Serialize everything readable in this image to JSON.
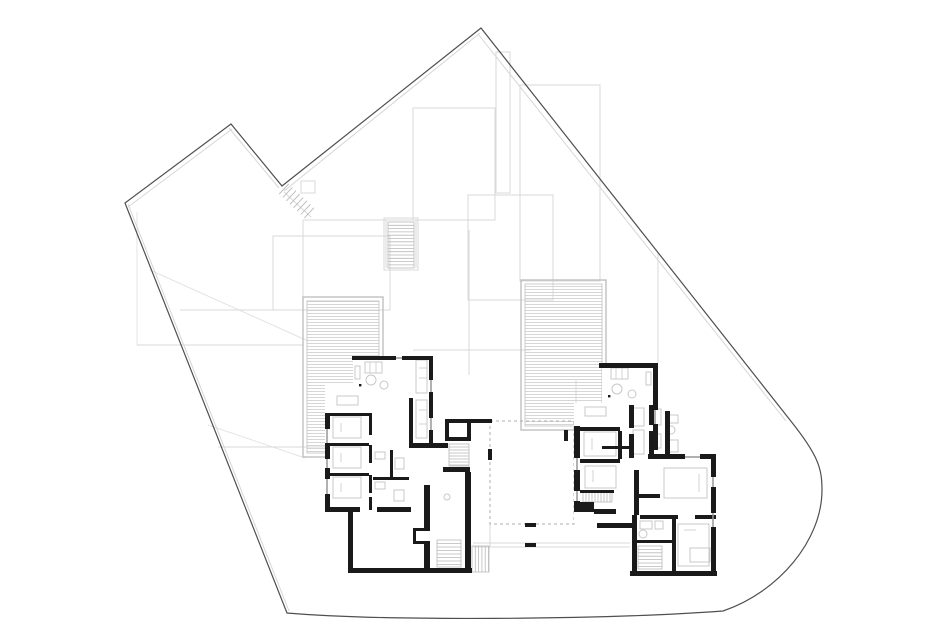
{
  "canvas": {
    "width": 940,
    "height": 635,
    "background": "#ffffff"
  },
  "colors": {
    "boundary": "#4f4f4f",
    "boundary_offset": "#d6d6d6",
    "roof_gray": "#d9d9d9",
    "terrain_gray": "#e4e4e4",
    "wall_black": "#1a1a1a",
    "window_gray": "#979797",
    "furniture_gray": "#c8c8c8",
    "stair_gray": "#b9b9b9",
    "deck_stripe": "#d2d2d2",
    "deck_frame": "#c0c0c0",
    "dash_gray": "#aeaeae",
    "fill_white": "#ffffff"
  },
  "site": {
    "boundary_path": "M125,203 L231,124 L282,186 L481,28 L790,420 C818,455 822,468 822,490 C822,540 779,592 723,611 C600,620 380,621 287,613 Z",
    "offset_lines": [
      [
        128,
        207,
        232,
        129
      ],
      [
        229,
        128,
        279,
        188
      ],
      [
        284,
        191,
        480,
        33
      ],
      [
        478,
        34,
        786,
        421
      ],
      [
        128,
        204,
        289,
        611
      ]
    ]
  },
  "gray_rects": [
    [
      413,
      108,
      82,
      112
    ],
    [
      496,
      52,
      14,
      141
    ],
    [
      468,
      195,
      85,
      105
    ],
    [
      273,
      236,
      117,
      74
    ],
    [
      520,
      85,
      80,
      196
    ],
    [
      384,
      218,
      34,
      52
    ],
    [
      301,
      181,
      14,
      12
    ]
  ],
  "gray_segments": [
    [
      303,
      220,
      413,
      220
    ],
    [
      303,
      220,
      303,
      297
    ],
    [
      180,
      310,
      390,
      310
    ],
    [
      137,
      345,
      303,
      345
    ],
    [
      218,
      447,
      400,
      447
    ],
    [
      413,
      350,
      530,
      350
    ],
    [
      658,
      252,
      658,
      367
    ],
    [
      469,
      230,
      469,
      375
    ],
    [
      386,
      220,
      386,
      268
    ],
    [
      416,
      220,
      416,
      268
    ],
    [
      284,
      192,
      311,
      217
    ],
    [
      470,
      543,
      632,
      543
    ],
    [
      470,
      547,
      632,
      547
    ],
    [
      490,
      523,
      490,
      547
    ],
    [
      330,
      385,
      330,
      415
    ],
    [
      576,
      380,
      576,
      426
    ],
    [
      602,
      367,
      602,
      405
    ]
  ],
  "terrain_segments": [
    [
      150,
      270,
      308,
      341
    ],
    [
      208,
      425,
      305,
      458
    ],
    [
      137,
      345,
      137,
      212
    ]
  ],
  "decks": [
    {
      "x": 303,
      "y": 297,
      "w": 80,
      "h": 160
    },
    {
      "x": 521,
      "y": 280,
      "w": 85,
      "h": 150
    }
  ],
  "courtyard": {
    "rect": [
      490,
      421,
      84,
      103
    ],
    "ticks": [
      [
        488,
        449,
        4,
        11
      ],
      [
        564,
        430,
        4,
        11
      ],
      [
        525,
        523,
        11,
        4
      ],
      [
        525,
        543,
        11,
        4
      ]
    ]
  },
  "unit_fills": [
    [
      353,
      356,
      80,
      92
    ],
    [
      325,
      383,
      87,
      129
    ],
    [
      405,
      396,
      30,
      52
    ],
    [
      433,
      420,
      40,
      155
    ],
    [
      348,
      511,
      77,
      62
    ],
    [
      602,
      363,
      58,
      70
    ],
    [
      574,
      403,
      82,
      120
    ],
    [
      630,
      454,
      86,
      122
    ]
  ],
  "walls": [
    [
      352,
      356,
      44,
      4
    ],
    [
      402,
      356,
      31,
      4
    ],
    [
      429,
      356,
      4,
      24
    ],
    [
      429,
      392,
      4,
      26
    ],
    [
      429,
      430,
      4,
      14
    ],
    [
      325,
      413,
      5,
      16
    ],
    [
      325,
      443,
      5,
      16
    ],
    [
      325,
      468,
      5,
      11
    ],
    [
      325,
      494,
      5,
      18
    ],
    [
      325,
      507,
      35,
      5
    ],
    [
      377,
      507,
      34,
      5
    ],
    [
      409,
      398,
      4,
      50
    ],
    [
      409,
      443,
      39,
      5
    ],
    [
      330,
      413,
      39,
      3
    ],
    [
      330,
      443,
      39,
      3
    ],
    [
      330,
      473,
      39,
      3
    ],
    [
      369,
      413,
      3,
      22
    ],
    [
      369,
      445,
      3,
      18
    ],
    [
      369,
      475,
      3,
      18
    ],
    [
      369,
      497,
      3,
      13
    ],
    [
      373,
      477,
      36,
      3
    ],
    [
      390,
      450,
      3,
      27
    ],
    [
      445,
      419,
      26,
      4
    ],
    [
      445,
      419,
      4,
      22
    ],
    [
      467,
      419,
      4,
      22
    ],
    [
      445,
      437,
      26,
      4
    ],
    [
      443,
      467,
      27,
      5
    ],
    [
      465,
      472,
      6,
      101
    ],
    [
      470,
      419,
      22,
      4
    ],
    [
      348,
      511,
      5,
      62
    ],
    [
      348,
      568,
      124,
      5
    ],
    [
      424,
      485,
      6,
      43
    ],
    [
      424,
      544,
      6,
      26
    ],
    [
      413,
      528,
      17,
      3
    ],
    [
      413,
      528,
      3,
      16
    ],
    [
      413,
      541,
      17,
      3
    ],
    [
      599,
      363,
      46,
      5
    ],
    [
      645,
      363,
      13,
      5
    ],
    [
      653,
      363,
      5,
      47
    ],
    [
      653,
      424,
      5,
      26
    ],
    [
      574,
      426,
      6,
      32
    ],
    [
      574,
      470,
      6,
      21
    ],
    [
      574,
      501,
      6,
      11
    ],
    [
      580,
      427,
      40,
      4
    ],
    [
      580,
      459,
      40,
      4
    ],
    [
      580,
      490,
      34,
      3
    ],
    [
      618,
      431,
      4,
      28
    ],
    [
      629,
      405,
      5,
      23
    ],
    [
      629,
      434,
      5,
      24
    ],
    [
      649,
      405,
      5,
      20
    ],
    [
      649,
      431,
      5,
      27
    ],
    [
      665,
      411,
      5,
      47
    ],
    [
      602,
      446,
      28,
      3
    ],
    [
      575,
      502,
      19,
      10
    ],
    [
      594,
      509,
      22,
      5
    ],
    [
      597,
      523,
      38,
      5
    ],
    [
      648,
      454,
      37,
      5
    ],
    [
      700,
      454,
      16,
      5
    ],
    [
      711,
      459,
      5,
      18
    ],
    [
      711,
      487,
      5,
      26
    ],
    [
      711,
      527,
      5,
      44
    ],
    [
      630,
      571,
      87,
      5
    ],
    [
      634,
      470,
      5,
      45
    ],
    [
      636,
      494,
      24,
      4
    ],
    [
      632,
      515,
      5,
      56
    ],
    [
      640,
      515,
      38,
      4
    ],
    [
      695,
      515,
      21,
      4
    ],
    [
      637,
      540,
      36,
      3
    ],
    [
      672,
      519,
      4,
      52
    ]
  ],
  "windows": [
    [
      396,
      358,
      402,
      358
    ],
    [
      431,
      380,
      431,
      392
    ],
    [
      431,
      418,
      431,
      430
    ],
    [
      327,
      429,
      327,
      443
    ],
    [
      327,
      459,
      327,
      468
    ],
    [
      327,
      479,
      327,
      494
    ],
    [
      577,
      458,
      577,
      470
    ],
    [
      577,
      491,
      577,
      501
    ],
    [
      655,
      410,
      655,
      424
    ],
    [
      685,
      457,
      700,
      457
    ],
    [
      713,
      477,
      713,
      487
    ],
    [
      713,
      513,
      713,
      527
    ]
  ],
  "stairs": [
    {
      "x": 449,
      "y": 444,
      "w": 20,
      "h": 22,
      "dir": "h",
      "step": 3
    },
    {
      "x": 388,
      "y": 222,
      "w": 26,
      "h": 46,
      "dir": "h",
      "step": 3.3
    },
    {
      "x": 437,
      "y": 540,
      "w": 24,
      "h": 27,
      "dir": "h",
      "step": 3.5
    },
    {
      "x": 583,
      "y": 491,
      "w": 29,
      "h": 11,
      "dir": "v",
      "step": 3
    },
    {
      "x": 638,
      "y": 546,
      "w": 24,
      "h": 23,
      "dir": "h",
      "step": 3.4
    },
    {
      "x": 472,
      "y": 546,
      "w": 17,
      "h": 26,
      "dir": "v",
      "step": 3.3
    }
  ],
  "boundary_stair": {
    "cx": 284,
    "cy": 189,
    "dx": 3.6,
    "dy": 3.4,
    "n": 8,
    "px": -4.8,
    "py": 5.1
  },
  "furniture_rects": [
    [
      365,
      362,
      17,
      11
    ],
    [
      355,
      366,
      5,
      13
    ],
    [
      337,
      396,
      21,
      9
    ],
    [
      416,
      360,
      11,
      33
    ],
    [
      416,
      400,
      11,
      38
    ],
    [
      333,
      417,
      28,
      21
    ],
    [
      333,
      447,
      28,
      21
    ],
    [
      333,
      477,
      28,
      21
    ],
    [
      375,
      452,
      10,
      7
    ],
    [
      395,
      458,
      9,
      11
    ],
    [
      375,
      482,
      10,
      7
    ],
    [
      394,
      490,
      10,
      11
    ],
    [
      611,
      368,
      17,
      11
    ],
    [
      646,
      372,
      5,
      13
    ],
    [
      585,
      407,
      21,
      9
    ],
    [
      633,
      408,
      11,
      18
    ],
    [
      633,
      430,
      11,
      24
    ],
    [
      652,
      409,
      9,
      16
    ],
    [
      652,
      434,
      9,
      14
    ],
    [
      668,
      415,
      10,
      8
    ],
    [
      668,
      440,
      10,
      12
    ],
    [
      584,
      432,
      32,
      24
    ],
    [
      585,
      466,
      31,
      22
    ],
    [
      664,
      468,
      43,
      30
    ],
    [
      678,
      524,
      31,
      42
    ],
    [
      640,
      521,
      12,
      8
    ],
    [
      655,
      521,
      8,
      8
    ],
    [
      690,
      548,
      20,
      14
    ]
  ],
  "furniture_circles": [
    [
      371,
      380,
      5
    ],
    [
      384,
      385,
      4
    ],
    [
      617,
      389,
      5
    ],
    [
      632,
      394,
      4
    ],
    [
      447,
      497,
      3
    ],
    [
      671,
      430,
      4
    ],
    [
      643,
      534,
      4
    ]
  ],
  "furniture_lines": [
    [
      370,
      362,
      370,
      373
    ],
    [
      376,
      362,
      376,
      373
    ],
    [
      616,
      368,
      616,
      379
    ],
    [
      622,
      368,
      622,
      379
    ],
    [
      419,
      368,
      427,
      368
    ],
    [
      419,
      378,
      427,
      378
    ],
    [
      419,
      410,
      427,
      410
    ],
    [
      419,
      424,
      427,
      424
    ],
    [
      341,
      423,
      341,
      432
    ],
    [
      341,
      453,
      341,
      462
    ],
    [
      341,
      483,
      341,
      492
    ],
    [
      592,
      438,
      592,
      450
    ],
    [
      593,
      470,
      593,
      482
    ],
    [
      699,
      474,
      699,
      492
    ],
    [
      684,
      530,
      696,
      530
    ]
  ],
  "dots": [
    [
      359,
      384
    ],
    [
      608,
      395
    ]
  ]
}
